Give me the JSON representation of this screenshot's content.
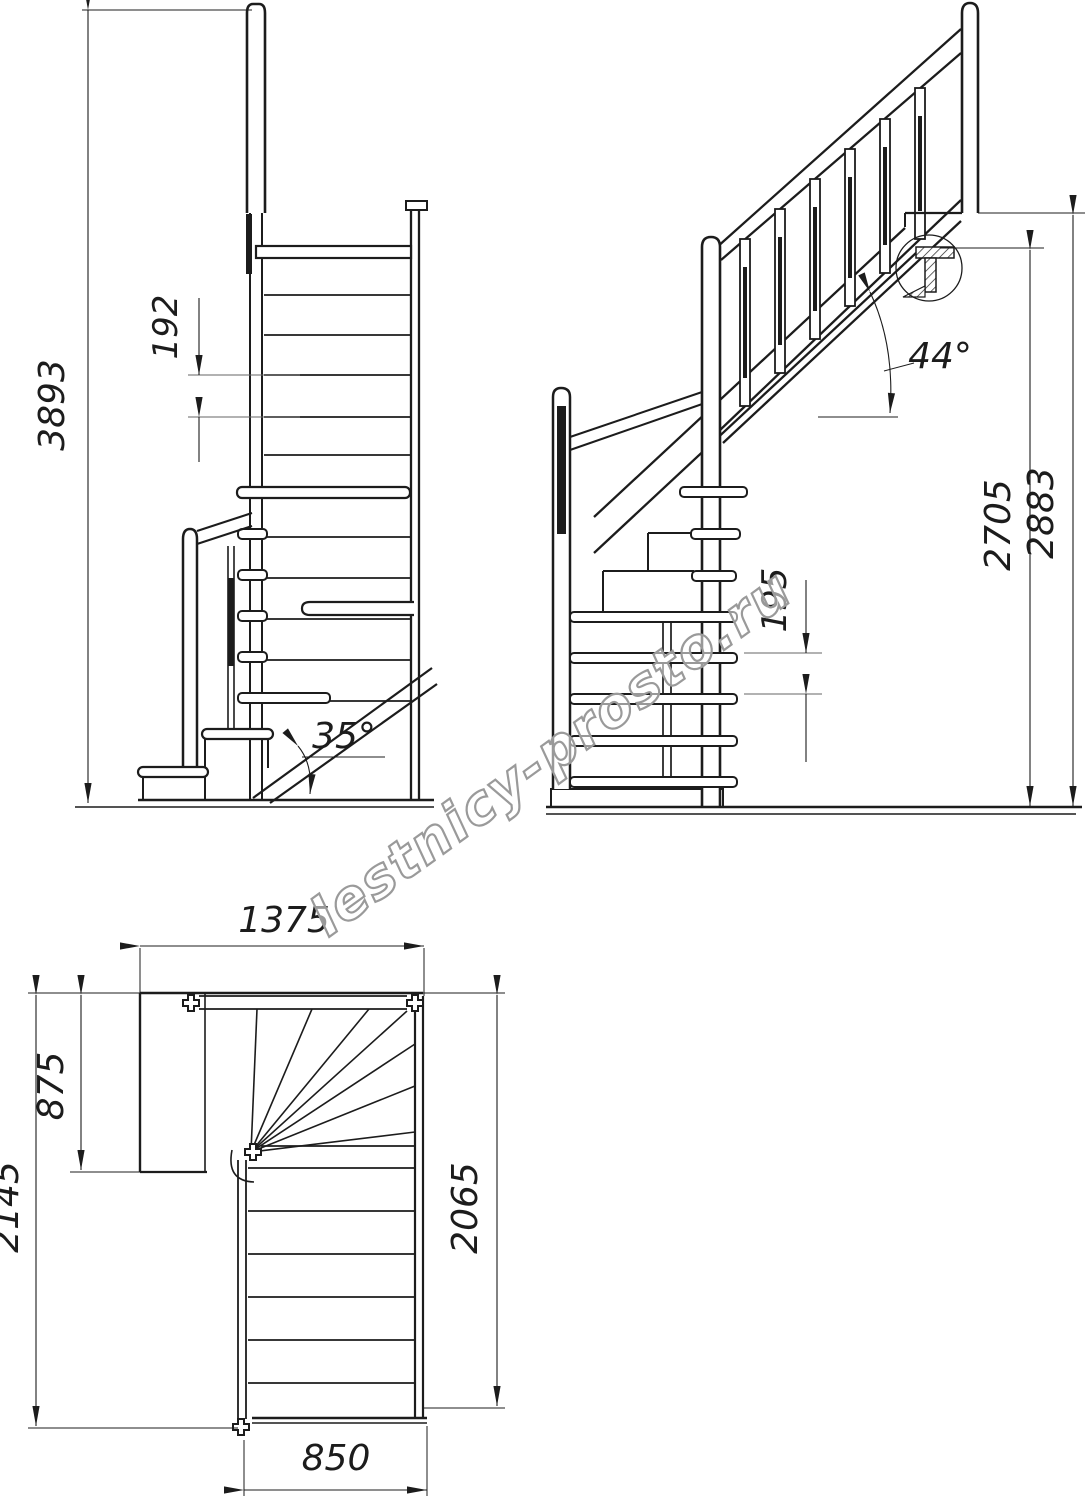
{
  "drawing": {
    "type": "staircase technical drawing",
    "watermark": "lestnicy-prosto.ru",
    "colors": {
      "line": "#1c1c1c",
      "dim": "#1c1c1c",
      "extension": "#666666",
      "watermark_outline": "#9a9a9a"
    }
  },
  "front": {
    "total_height": "3893",
    "rise": "192",
    "stringer_angle": "35°"
  },
  "side": {
    "rise": "195",
    "height_under_landing": "2705",
    "height_floor_to_floor": "2883",
    "flight_angle": "44°"
  },
  "plan": {
    "top_width": "1375",
    "landing_depth": "875",
    "total_length": "2145",
    "flight_length": "2065",
    "flight_width": "850"
  }
}
